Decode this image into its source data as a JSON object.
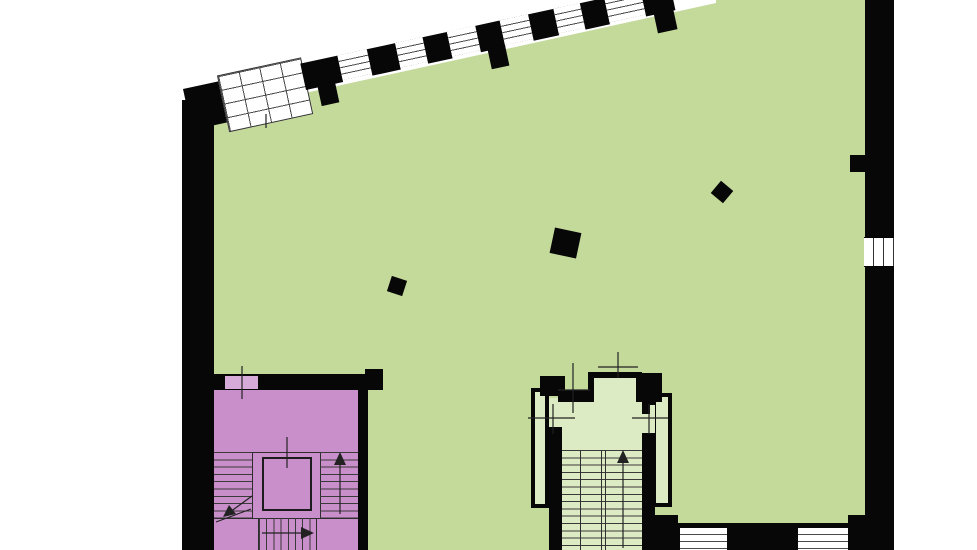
{
  "document": {
    "type": "architectural-floor-plan",
    "visible_text": [],
    "notes": "Plan drawing with no labels: large hall, stairwell, central stair core, glazed facade band"
  },
  "palette": {
    "background": "#ffffff",
    "walls": "#070707",
    "main_hall_fill": "#c4da9b",
    "stair_core_fill": "#ddebc4",
    "secondary_stair_fill": "#c98fcb",
    "door_leaf_fill": "#d7abd9",
    "thin_line": "#333333"
  },
  "areas": [
    {
      "name": "main-hall",
      "fill_key": "main_hall_fill"
    },
    {
      "name": "purple-stairwell",
      "fill_key": "secondary_stair_fill"
    },
    {
      "name": "central-stair-core",
      "fill_key": "stair_core_fill"
    },
    {
      "name": "entry-vestibule",
      "fill_key": "stair_core_fill"
    }
  ],
  "elements": {
    "freestanding_columns": 3,
    "facade_piers": 7,
    "facade_windows": 6,
    "glass_grid_window": 1,
    "right_wall_window_panes": 3,
    "bottom_wall_windows": 2,
    "elevator_shaft": 1,
    "stair_direction_arrows": [
      "up",
      "up",
      "right",
      "down-left"
    ]
  }
}
